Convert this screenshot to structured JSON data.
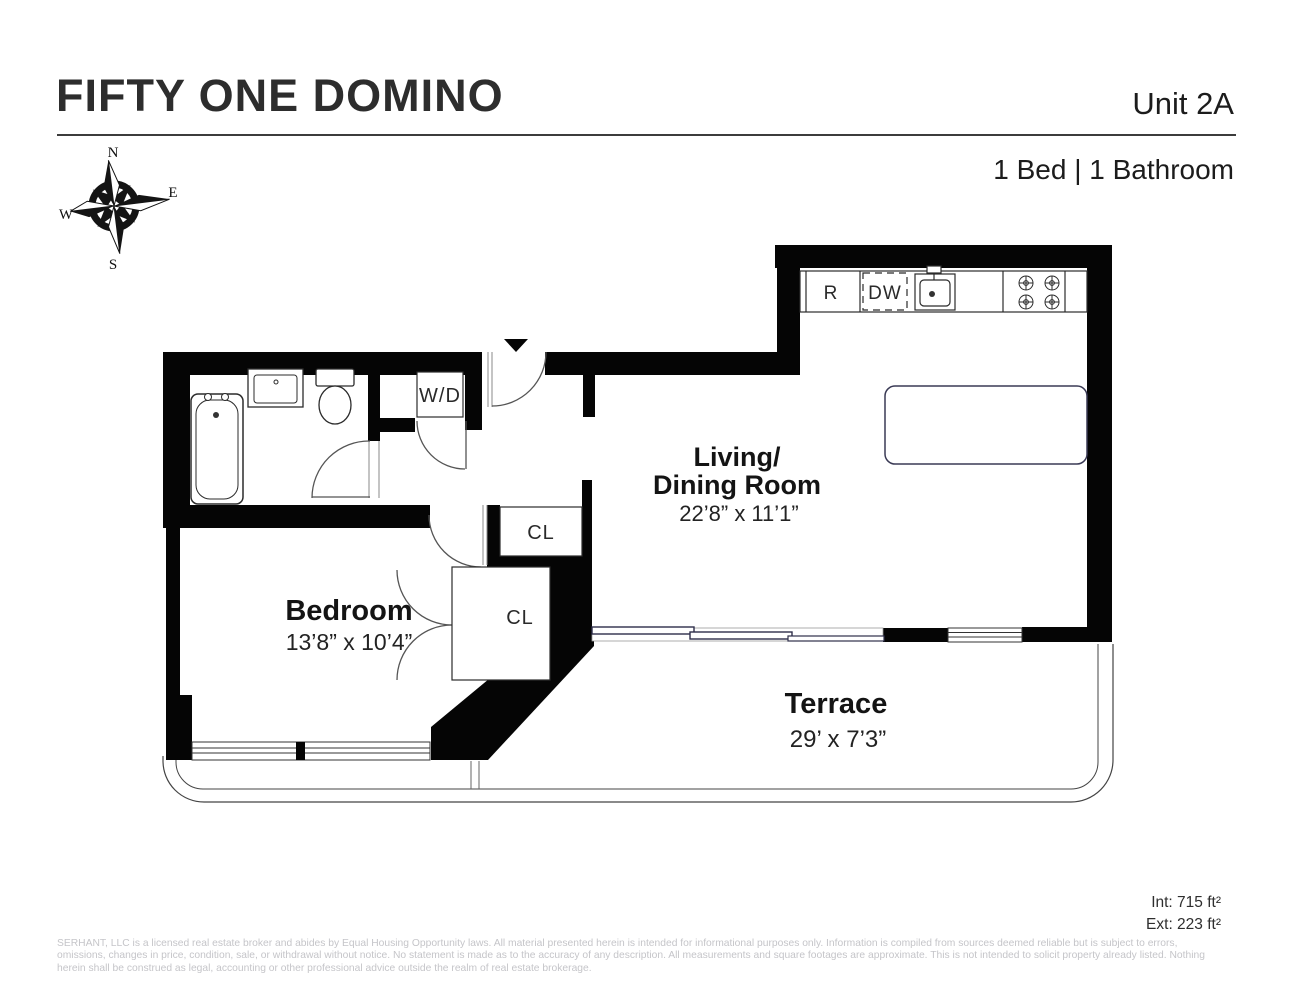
{
  "header": {
    "building": "FIFTY ONE DOMINO",
    "unit": "Unit 2A",
    "configuration": "1 Bed | 1 Bathroom"
  },
  "compass": {
    "n": "N",
    "e": "E",
    "s": "S",
    "w": "W"
  },
  "rooms": {
    "living": {
      "line1": "Living/",
      "line2": "Dining Room",
      "dims": "22’8” x 11’1”"
    },
    "bedroom": {
      "name": "Bedroom",
      "dims": "13’8” x 10’4”"
    },
    "terrace": {
      "name": "Terrace",
      "dims": "29’ x 7’3”"
    },
    "closet_upper": {
      "label": "CL"
    },
    "closet_lower": {
      "label": "CL"
    },
    "laundry": {
      "label": "W/D"
    }
  },
  "kitchen": {
    "refrigerator": "R",
    "dishwasher": "DW"
  },
  "areas": {
    "interior": "Int: 715 ft²",
    "exterior": "Ext: 223 ft²"
  },
  "footer": {
    "line1": "SERHANT, LLC is a licensed real estate broker and abides by Equal Housing Opportunity laws. All material presented herein is intended for informational purposes only. Information is compiled from sources deemed reliable but is subject to errors,",
    "line2": "omissions, changes in price, condition, sale, or withdrawal without notice. No statement is made as to the accuracy of any description. All measurements and square footages are approximate. This is not intended to solicit property already listed. Nothing",
    "line3": "herein shall be construed as legal, accounting or other professional advice outside the realm of real estate brokerage."
  },
  "colors": {
    "wall": "#050505",
    "glazing": "#2e2e4a",
    "island_stroke": "#3a3a55",
    "muted_text": "#c5c5c9"
  }
}
